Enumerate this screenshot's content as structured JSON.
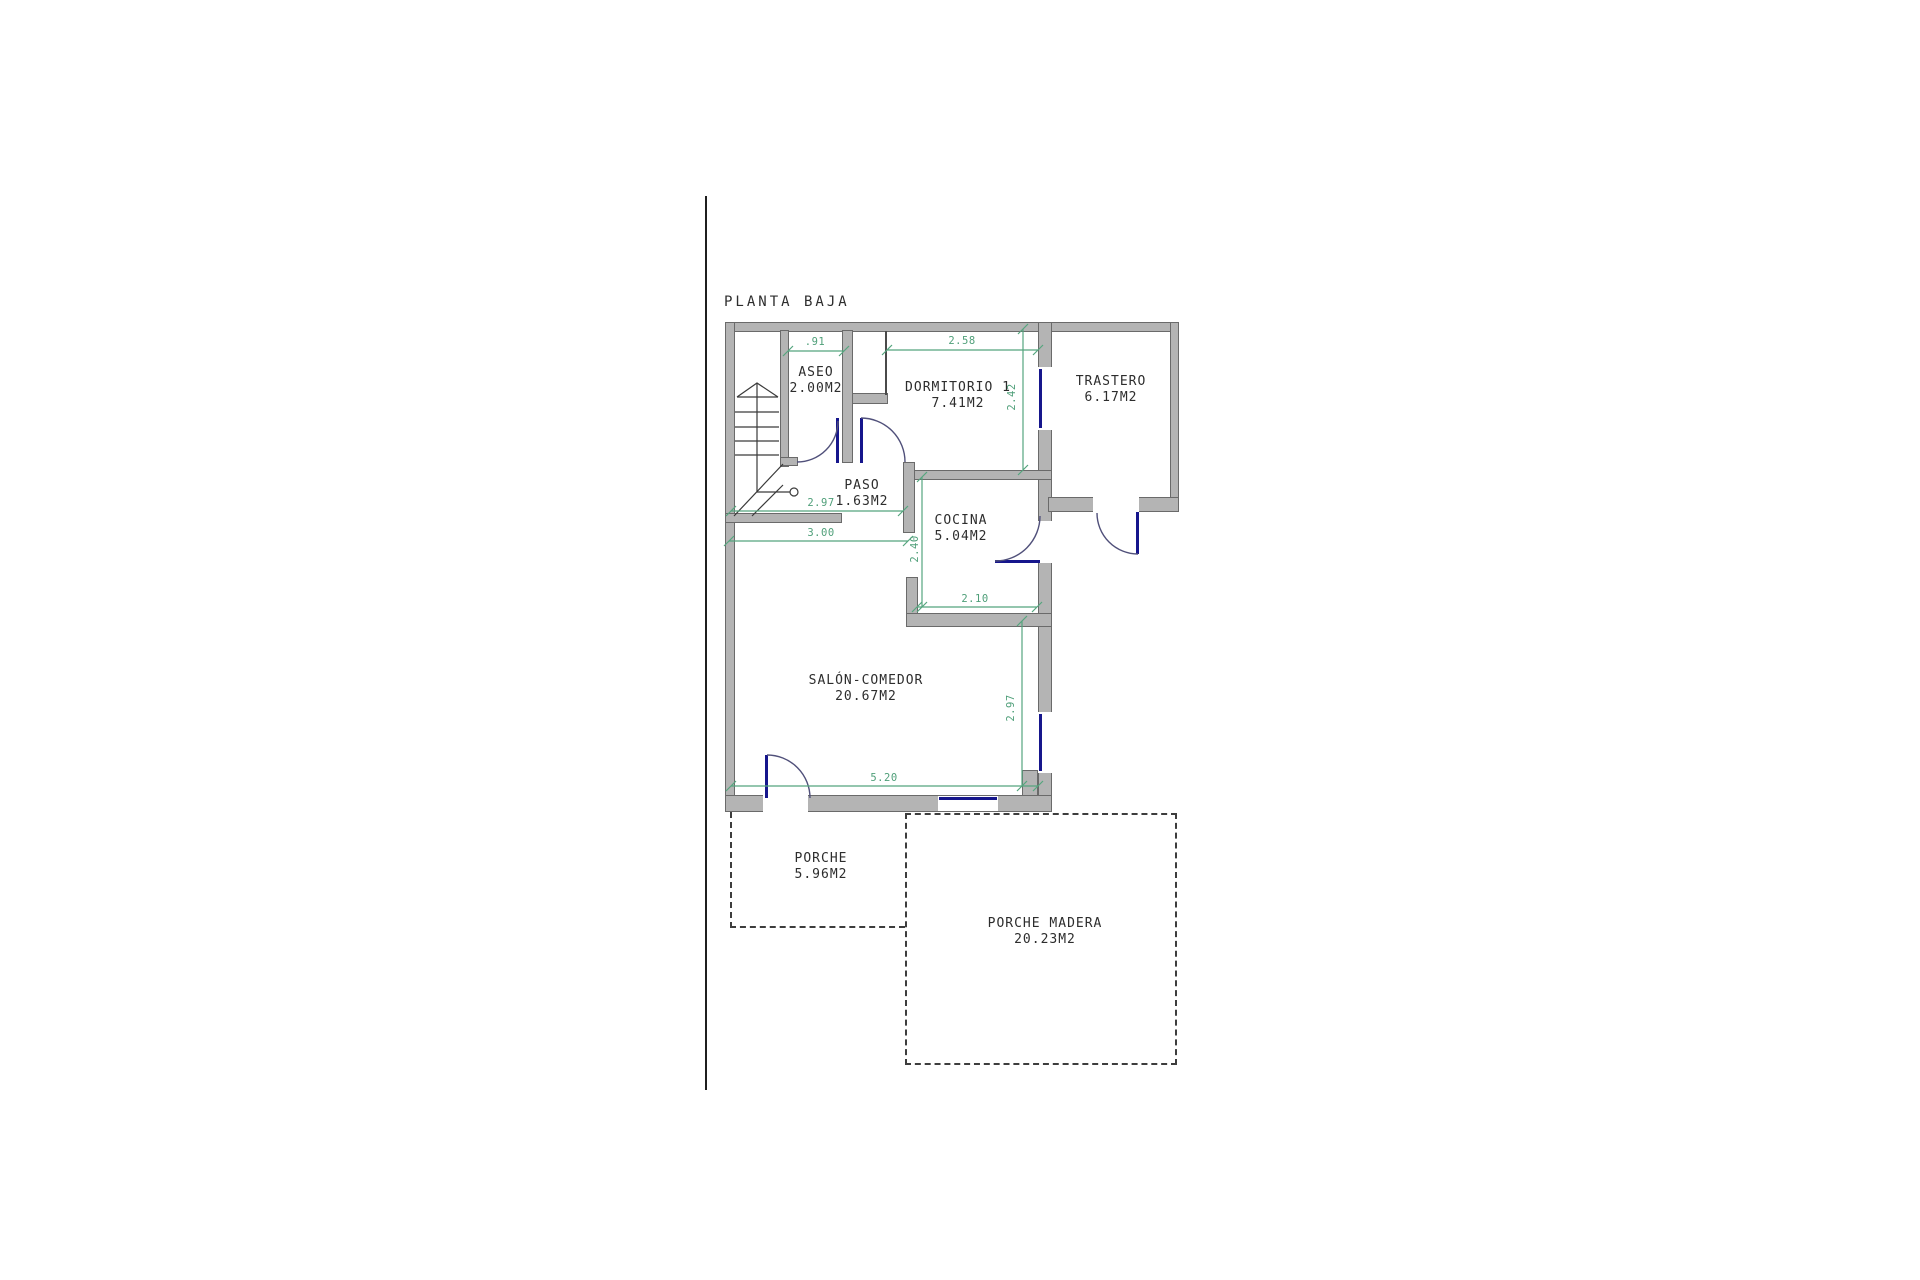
{
  "title": "PLANTA BAJA",
  "rooms": [
    {
      "id": "aseo",
      "name": "ASEO",
      "area": "2.00M2"
    },
    {
      "id": "dormitorio-1",
      "name": "DORMITORIO 1",
      "area": "7.41M2"
    },
    {
      "id": "trastero",
      "name": "TRASTERO",
      "area": "6.17M2"
    },
    {
      "id": "paso",
      "name": "PASO",
      "area": "1.63M2"
    },
    {
      "id": "cocina",
      "name": "COCINA",
      "area": "5.04M2"
    },
    {
      "id": "salon-comedor",
      "name": "SALÓN-COMEDOR",
      "area": "20.67M2"
    },
    {
      "id": "porche",
      "name": "PORCHE",
      "area": "5.96M2"
    },
    {
      "id": "porche-madera",
      "name": "PORCHE MADERA",
      "area": "20.23M2"
    }
  ],
  "dimensions": [
    {
      "label": ".91",
      "orientation": "horizontal"
    },
    {
      "label": "2.58",
      "orientation": "horizontal"
    },
    {
      "label": "2.42",
      "orientation": "vertical"
    },
    {
      "label": "2.97",
      "orientation": "horizontal"
    },
    {
      "label": "3.00",
      "orientation": "horizontal"
    },
    {
      "label": "2.40",
      "orientation": "vertical"
    },
    {
      "label": "2.10",
      "orientation": "horizontal"
    },
    {
      "label": "2.97",
      "orientation": "vertical"
    },
    {
      "label": "5.20",
      "orientation": "horizontal"
    }
  ],
  "colors": {
    "wall_fill": "#b4b4b4",
    "wall_edge": "#6a6a6a",
    "dimension_green": "#4f9f79",
    "door_window_navy": "#16168c",
    "line_dark": "#3a3a3a"
  }
}
